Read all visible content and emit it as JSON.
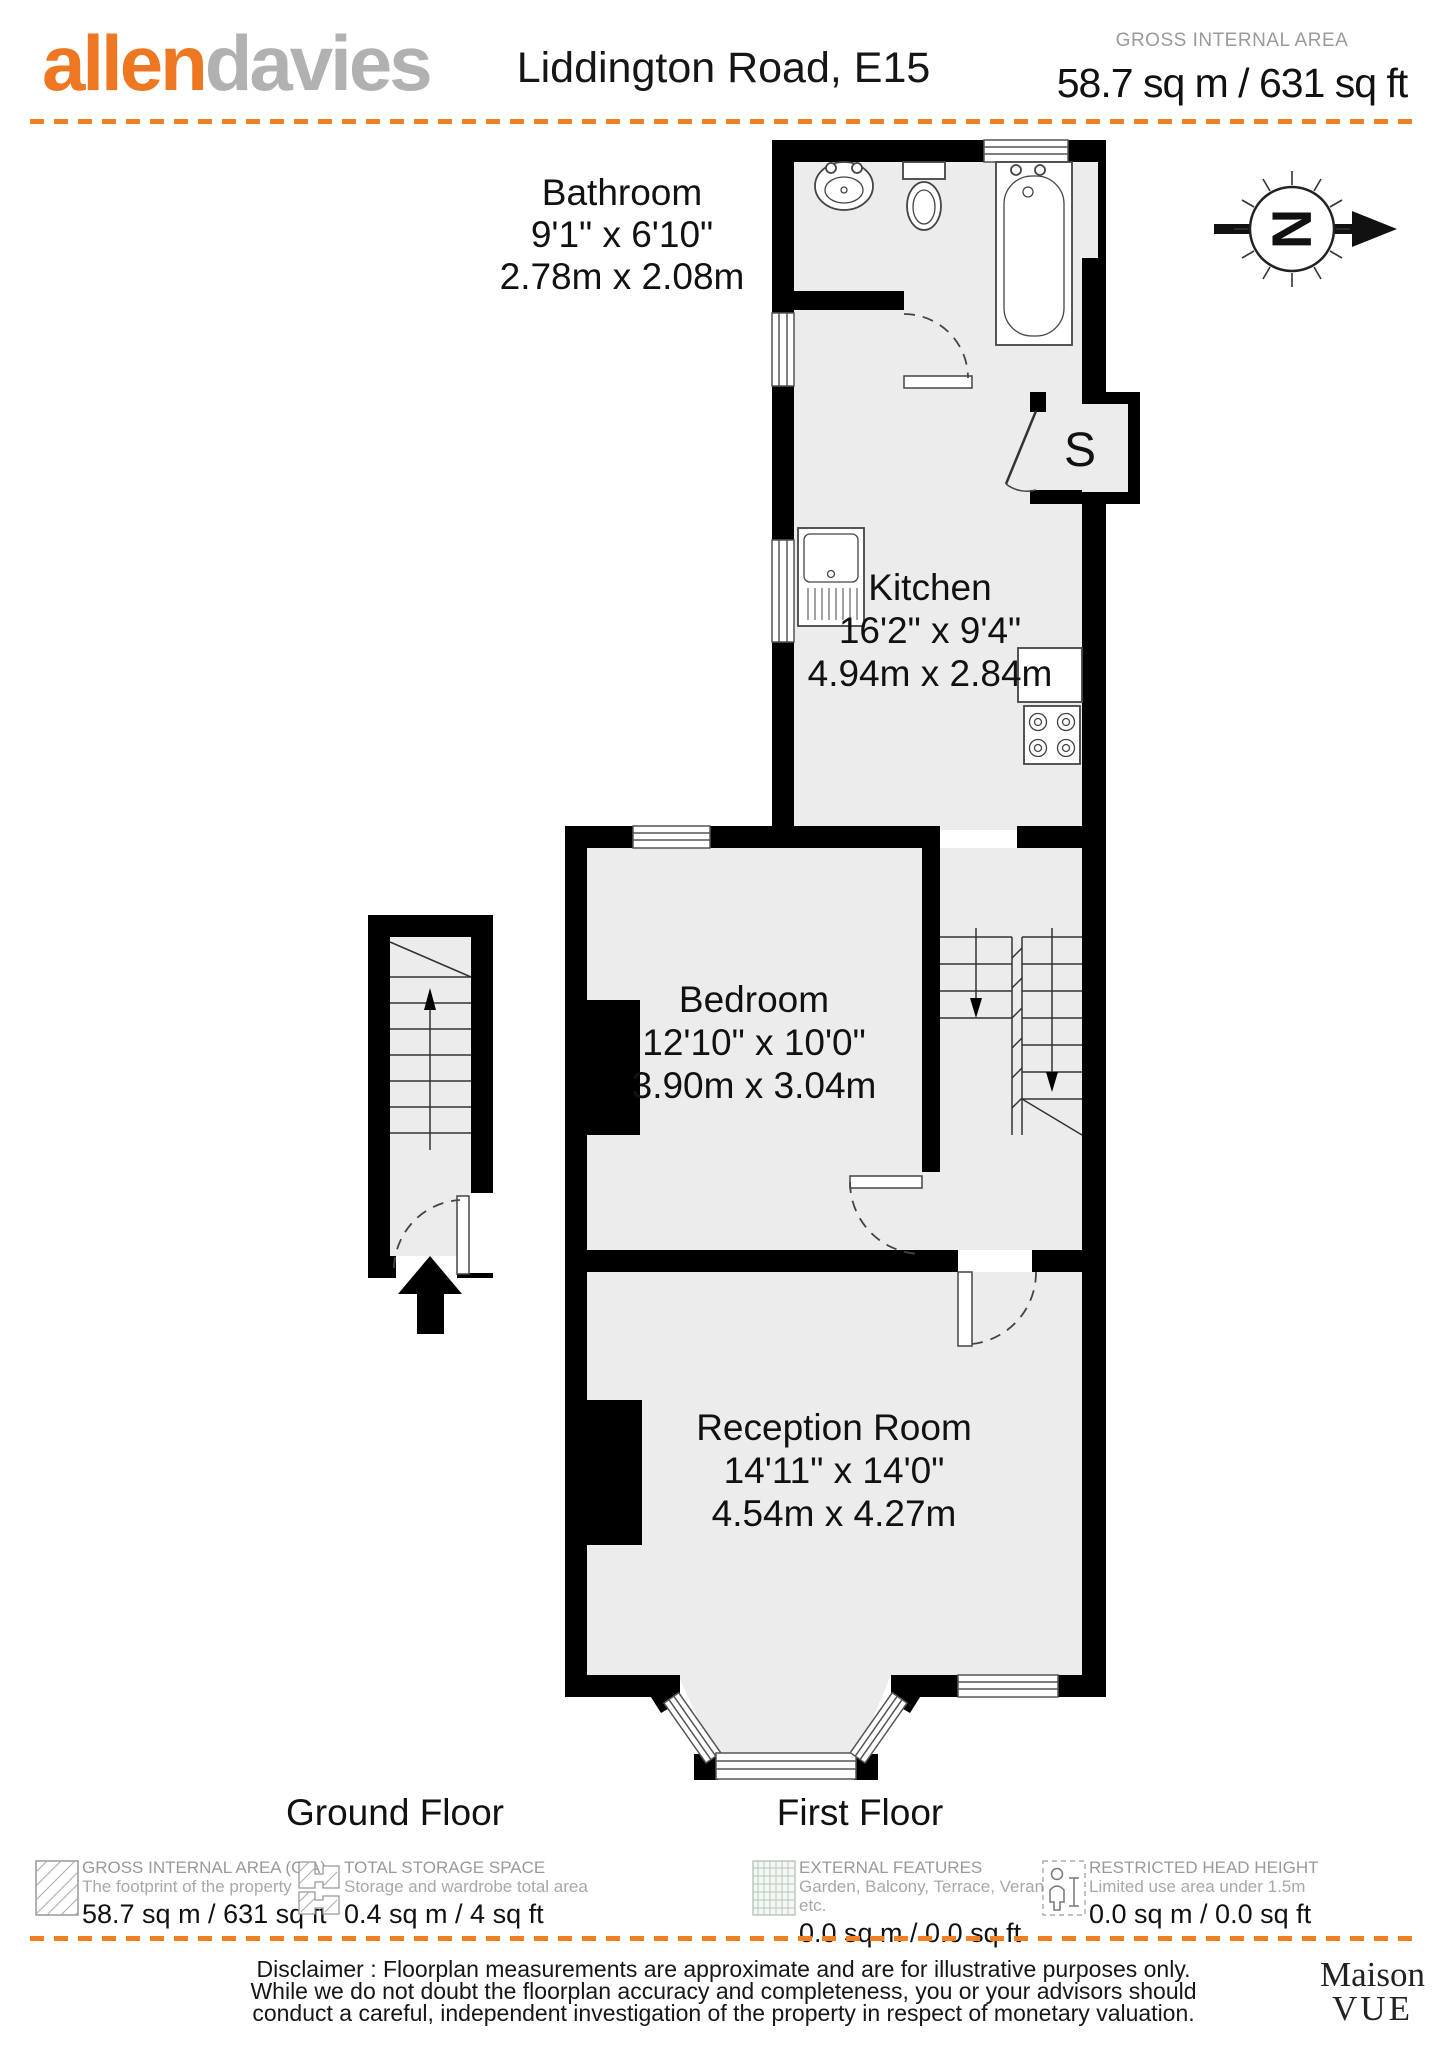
{
  "header": {
    "logo_allen": "allen",
    "logo_davies": "davies",
    "title": "Liddington Road, E15",
    "gia_label": "GROSS INTERNAL AREA",
    "gia_value": "58.7 sq m / 631 sq ft"
  },
  "compass": {
    "letter": "N"
  },
  "plan": {
    "rooms": {
      "bathroom": {
        "name": "Bathroom",
        "imperial": "9'1\" x 6'10\"",
        "metric": "2.78m x 2.08m"
      },
      "kitchen": {
        "name": "Kitchen",
        "imperial": "16'2\" x 9'4\"",
        "metric": "4.94m x 2.84m"
      },
      "bedroom": {
        "name": "Bedroom",
        "imperial": "12'10\" x 10'0\"",
        "metric": "3.90m x 3.04m"
      },
      "reception": {
        "name": "Reception Room",
        "imperial": "14'11\" x 14'0\"",
        "metric": "4.54m x 4.27m"
      },
      "storage": {
        "label": "S"
      }
    },
    "floors": {
      "ground": "Ground Floor",
      "first": "First Floor"
    }
  },
  "legend": {
    "items": [
      {
        "icon": "gia-hatch-icon",
        "title": "GROSS INTERNAL AREA (GIA)",
        "subtitle": "The footprint of the property",
        "value": "58.7 sq m / 631 sq ft"
      },
      {
        "icon": "storage-hatch-icon",
        "title": "TOTAL STORAGE SPACE",
        "subtitle": "Storage and wardrobe total area",
        "value": "0.4 sq m / 4 sq ft"
      },
      {
        "icon": "external-grid-icon",
        "title": "EXTERNAL FEATURES",
        "subtitle": "Garden, Balcony, Terrace, Verandah etc.",
        "value": "0.0 sq m / 0.0 sq ft"
      },
      {
        "icon": "head-height-icon",
        "title": "RESTRICTED HEAD HEIGHT",
        "subtitle": "Limited use area under 1.5m",
        "value": "0.0 sq m / 0.0 sq ft"
      }
    ]
  },
  "footer": {
    "disclaimer_lines": [
      "Disclaimer : Floorplan measurements are approximate and are for illustrative purposes only.",
      "While we do not doubt the floorplan accuracy and completeness, you or your advisors should",
      "conduct a careful, independent investigation of the property in respect of monetary valuation."
    ],
    "maison_line1": "Maison",
    "maison_line2": "VUE"
  }
}
